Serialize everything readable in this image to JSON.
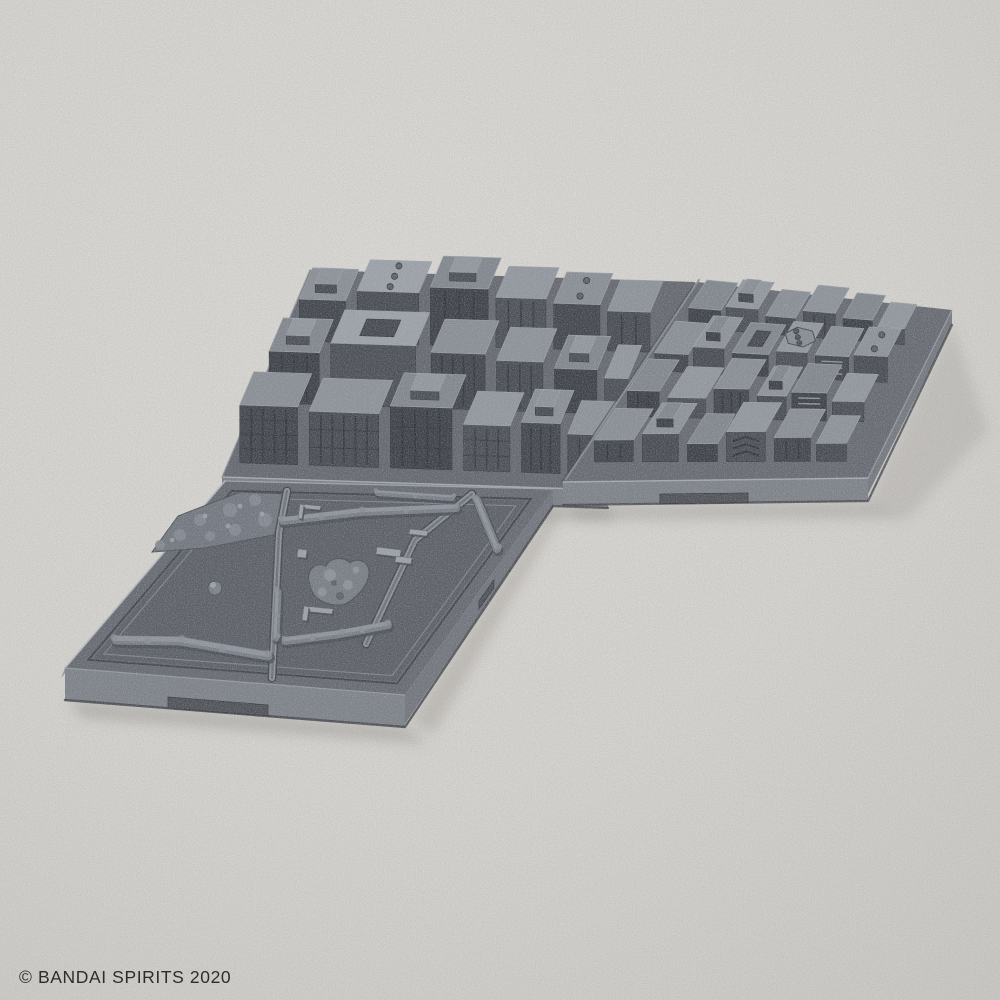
{
  "copyright": {
    "text": "© BANDAI SPIRITS 2020"
  },
  "colors": {
    "background": "#d6d4d0",
    "background_edge": "#cac8c4",
    "plastic_top": "#61656d",
    "plastic_top_inner": "#585c64",
    "plastic_side_light": "#8e939a",
    "plastic_side_front": "#7a7f87",
    "plastic_side_dark": "#6e737b",
    "building_top": "#878d95",
    "building_top_light": "#9ba1a9",
    "building_front": "#3d414a",
    "building_side": "#555a62",
    "groove_dark": "#383c43",
    "edge_highlight": "#a9afb7",
    "notch_dark": "#4a4e54",
    "shadow": "#97948f",
    "text": "#2d2d2d"
  }
}
